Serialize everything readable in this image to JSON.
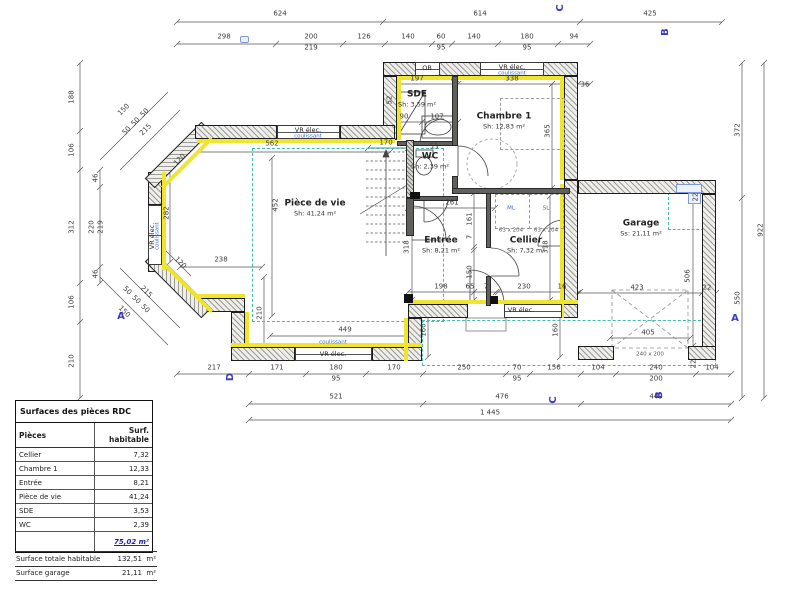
{
  "colors": {
    "insulation": "#efe42e",
    "teal_dashed": "#41bcae",
    "marker_blue": "#3b3bbf",
    "total_blue": "#2222bb"
  },
  "surface_table": {
    "title": "Surfaces des pièces RDC",
    "col_piece": "Pièces",
    "col_surface": "Surf. habitable",
    "rows": [
      [
        "Cellier",
        "7,32"
      ],
      [
        "Chambre 1",
        "12,33"
      ],
      [
        "Entrée",
        "8,21"
      ],
      [
        "Pièce de vie",
        "41,24"
      ],
      [
        "SDE",
        "3,53"
      ],
      [
        "WC",
        "2,39"
      ]
    ],
    "total": "75,02 m²",
    "summary": [
      [
        "Surface totale habitable",
        "132,51",
        "m²"
      ],
      [
        "Surface garage",
        "21,11",
        "m²"
      ]
    ]
  },
  "rooms": [
    {
      "name": "Pièce de vie",
      "area": "Sh:   41,24 m²",
      "x": 315,
      "y": 208
    },
    {
      "name": "Chambre 1",
      "area": "Sh:  12,83 m²",
      "x": 504,
      "y": 121
    },
    {
      "name": "Entrée",
      "area": "Sh: 8,21 m²",
      "x": 441,
      "y": 245
    },
    {
      "name": "Cellier",
      "area": "Sh: 7,32 m²",
      "x": 526,
      "y": 245
    },
    {
      "name": "Garage",
      "area": "Ss: 21,11 m²",
      "x": 641,
      "y": 228
    },
    {
      "name": "SDE",
      "area": "Sh: 3,59 m²",
      "x": 417,
      "y": 99
    },
    {
      "name": "WC",
      "area": "Sh: 2,39 m²",
      "x": 430,
      "y": 161
    }
  ],
  "dim_labels": [
    {
      "t": "624",
      "x": 280,
      "y": 14
    },
    {
      "t": "614",
      "x": 480,
      "y": 14
    },
    {
      "t": "425",
      "x": 650,
      "y": 14
    },
    {
      "t": "298",
      "x": 224,
      "y": 37
    },
    {
      "t": "200",
      "x": 311,
      "y": 37
    },
    {
      "t": "219",
      "x": 311,
      "y": 48
    },
    {
      "t": "126",
      "x": 364,
      "y": 37
    },
    {
      "t": "140",
      "x": 408,
      "y": 37
    },
    {
      "t": "60",
      "x": 441,
      "y": 37
    },
    {
      "t": "95",
      "x": 441,
      "y": 48
    },
    {
      "t": "140",
      "x": 474,
      "y": 37
    },
    {
      "t": "180",
      "x": 527,
      "y": 37
    },
    {
      "t": "95",
      "x": 527,
      "y": 48
    },
    {
      "t": "94",
      "x": 574,
      "y": 37
    },
    {
      "t": "188",
      "x": 72,
      "y": 97,
      "r": -90
    },
    {
      "t": "106",
      "x": 72,
      "y": 150,
      "r": -90
    },
    {
      "t": "312",
      "x": 72,
      "y": 227,
      "r": -90
    },
    {
      "t": "106",
      "x": 72,
      "y": 302,
      "r": -90
    },
    {
      "t": "210",
      "x": 72,
      "y": 361,
      "r": -90
    },
    {
      "t": "46",
      "x": 96,
      "y": 178,
      "r": -90
    },
    {
      "t": "220",
      "x": 92,
      "y": 227,
      "r": -90
    },
    {
      "t": "219",
      "x": 101,
      "y": 227,
      "r": -90
    },
    {
      "t": "46",
      "x": 96,
      "y": 274,
      "r": -90
    },
    {
      "t": "150",
      "x": 124,
      "y": 110,
      "r": -45
    },
    {
      "t": "50",
      "x": 127,
      "y": 131,
      "r": -45
    },
    {
      "t": "50",
      "x": 136,
      "y": 122,
      "r": -45
    },
    {
      "t": "50",
      "x": 145,
      "y": 113,
      "r": -45
    },
    {
      "t": "215",
      "x": 146,
      "y": 130,
      "r": -45
    },
    {
      "t": "150",
      "x": 124,
      "y": 312,
      "r": 45
    },
    {
      "t": "50",
      "x": 127,
      "y": 291,
      "r": 45
    },
    {
      "t": "50",
      "x": 136,
      "y": 300,
      "r": 45
    },
    {
      "t": "50",
      "x": 145,
      "y": 309,
      "r": 45
    },
    {
      "t": "215",
      "x": 146,
      "y": 292,
      "r": 45
    },
    {
      "t": "120",
      "x": 180,
      "y": 160,
      "r": -45
    },
    {
      "t": "120",
      "x": 180,
      "y": 263,
      "r": 45
    },
    {
      "t": "282",
      "x": 167,
      "y": 213,
      "r": -90
    },
    {
      "t": "452",
      "x": 276,
      "y": 205,
      "r": -90
    },
    {
      "t": "562",
      "x": 272,
      "y": 144
    },
    {
      "t": "238",
      "x": 221,
      "y": 260
    },
    {
      "t": "210",
      "x": 260,
      "y": 313,
      "r": -90
    },
    {
      "t": "449",
      "x": 345,
      "y": 330
    },
    {
      "t": "197",
      "x": 417,
      "y": 79
    },
    {
      "t": "7",
      "x": 452,
      "y": 79
    },
    {
      "t": "338",
      "x": 512,
      "y": 79
    },
    {
      "t": "36",
      "x": 585,
      "y": 85
    },
    {
      "t": "365",
      "x": 548,
      "y": 131,
      "r": -90
    },
    {
      "t": "52",
      "x": 390,
      "y": 100,
      "r": -90
    },
    {
      "t": "90",
      "x": 404,
      "y": 117
    },
    {
      "t": "107",
      "x": 437,
      "y": 117
    },
    {
      "t": "53",
      "x": 434,
      "y": 147
    },
    {
      "t": "170",
      "x": 386,
      "y": 143
    },
    {
      "t": "261",
      "x": 452,
      "y": 203
    },
    {
      "t": "161",
      "x": 470,
      "y": 219,
      "r": -90
    },
    {
      "t": "7",
      "x": 470,
      "y": 237,
      "r": -90
    },
    {
      "t": "150",
      "x": 470,
      "y": 272,
      "r": -90
    },
    {
      "t": "318",
      "x": 407,
      "y": 247,
      "r": -90
    },
    {
      "t": "318",
      "x": 546,
      "y": 247,
      "r": -90
    },
    {
      "t": "198",
      "x": 441,
      "y": 287
    },
    {
      "t": "65",
      "x": 470,
      "y": 287
    },
    {
      "t": "7",
      "x": 486,
      "y": 287
    },
    {
      "t": "230",
      "x": 524,
      "y": 287
    },
    {
      "t": "16",
      "x": 562,
      "y": 287
    },
    {
      "t": "160",
      "x": 424,
      "y": 330,
      "r": -90
    },
    {
      "t": "160",
      "x": 556,
      "y": 330,
      "r": -90
    },
    {
      "t": "423",
      "x": 637,
      "y": 288
    },
    {
      "t": "22",
      "x": 707,
      "y": 288
    },
    {
      "t": "506",
      "x": 688,
      "y": 276,
      "r": -90
    },
    {
      "t": "405",
      "x": 648,
      "y": 333
    },
    {
      "t": "22",
      "x": 696,
      "y": 197,
      "r": -90
    },
    {
      "t": "22",
      "x": 694,
      "y": 364,
      "r": -90
    },
    {
      "t": "372",
      "x": 738,
      "y": 130,
      "r": -90
    },
    {
      "t": "550",
      "x": 738,
      "y": 298,
      "r": -90
    },
    {
      "t": "922",
      "x": 761,
      "y": 230,
      "r": -90
    },
    {
      "t": "217",
      "x": 214,
      "y": 368
    },
    {
      "t": "171",
      "x": 277,
      "y": 368
    },
    {
      "t": "180",
      "x": 336,
      "y": 368
    },
    {
      "t": "95",
      "x": 336,
      "y": 379
    },
    {
      "t": "170",
      "x": 394,
      "y": 368
    },
    {
      "t": "250",
      "x": 464,
      "y": 368
    },
    {
      "t": "70",
      "x": 517,
      "y": 368
    },
    {
      "t": "95",
      "x": 517,
      "y": 379
    },
    {
      "t": "156",
      "x": 554,
      "y": 368
    },
    {
      "t": "104",
      "x": 598,
      "y": 368
    },
    {
      "t": "240",
      "x": 656,
      "y": 368
    },
    {
      "t": "200",
      "x": 656,
      "y": 379
    },
    {
      "t": "104",
      "x": 712,
      "y": 368
    },
    {
      "t": "521",
      "x": 336,
      "y": 397
    },
    {
      "t": "476",
      "x": 502,
      "y": 397
    },
    {
      "t": "449",
      "x": 656,
      "y": 397
    },
    {
      "t": "1 445",
      "x": 490,
      "y": 413
    }
  ],
  "annotations": [
    {
      "t": "VR élec.",
      "x": 512,
      "y": 67,
      "c": "d"
    },
    {
      "t": "coulissant",
      "x": 512,
      "y": 74,
      "c": "b"
    },
    {
      "t": "OB",
      "x": 427,
      "y": 68,
      "c": "d"
    },
    {
      "t": "VR élec.",
      "x": 308,
      "y": 130,
      "c": "d"
    },
    {
      "t": "coulissant",
      "x": 308,
      "y": 137,
      "c": "b"
    },
    {
      "t": "VR élec.",
      "x": 152,
      "y": 236,
      "c": "d",
      "r": -90
    },
    {
      "t": "coulissant",
      "x": 158,
      "y": 236,
      "c": "b",
      "r": -90
    },
    {
      "t": "coulissant",
      "x": 333,
      "y": 343,
      "c": "b"
    },
    {
      "t": "VR élec.",
      "x": 333,
      "y": 354,
      "c": "d"
    },
    {
      "t": "VR élec.",
      "x": 521,
      "y": 310,
      "c": "d"
    },
    {
      "t": "ML",
      "x": 511,
      "y": 209,
      "c": "b"
    },
    {
      "t": "SL",
      "x": 546,
      "y": 209,
      "c": "b"
    },
    {
      "t": "63 x 204",
      "x": 511,
      "y": 231,
      "c": "s"
    },
    {
      "t": "63 x 204",
      "x": 546,
      "y": 231,
      "c": "s"
    },
    {
      "t": "240 x 200",
      "x": 650,
      "y": 355,
      "c": "s"
    }
  ],
  "section_markers": [
    {
      "t": "A",
      "x": 121,
      "y": 317,
      "r": 0
    },
    {
      "t": "A",
      "x": 735,
      "y": 319,
      "r": 0
    },
    {
      "t": "B",
      "x": 666,
      "y": 32,
      "r": -90
    },
    {
      "t": "B",
      "x": 660,
      "y": 395,
      "r": -90
    },
    {
      "t": "C",
      "x": 561,
      "y": 8,
      "r": -90
    },
    {
      "t": "C",
      "x": 554,
      "y": 400,
      "r": -90
    },
    {
      "t": "D",
      "x": 231,
      "y": 377,
      "r": -90
    }
  ]
}
